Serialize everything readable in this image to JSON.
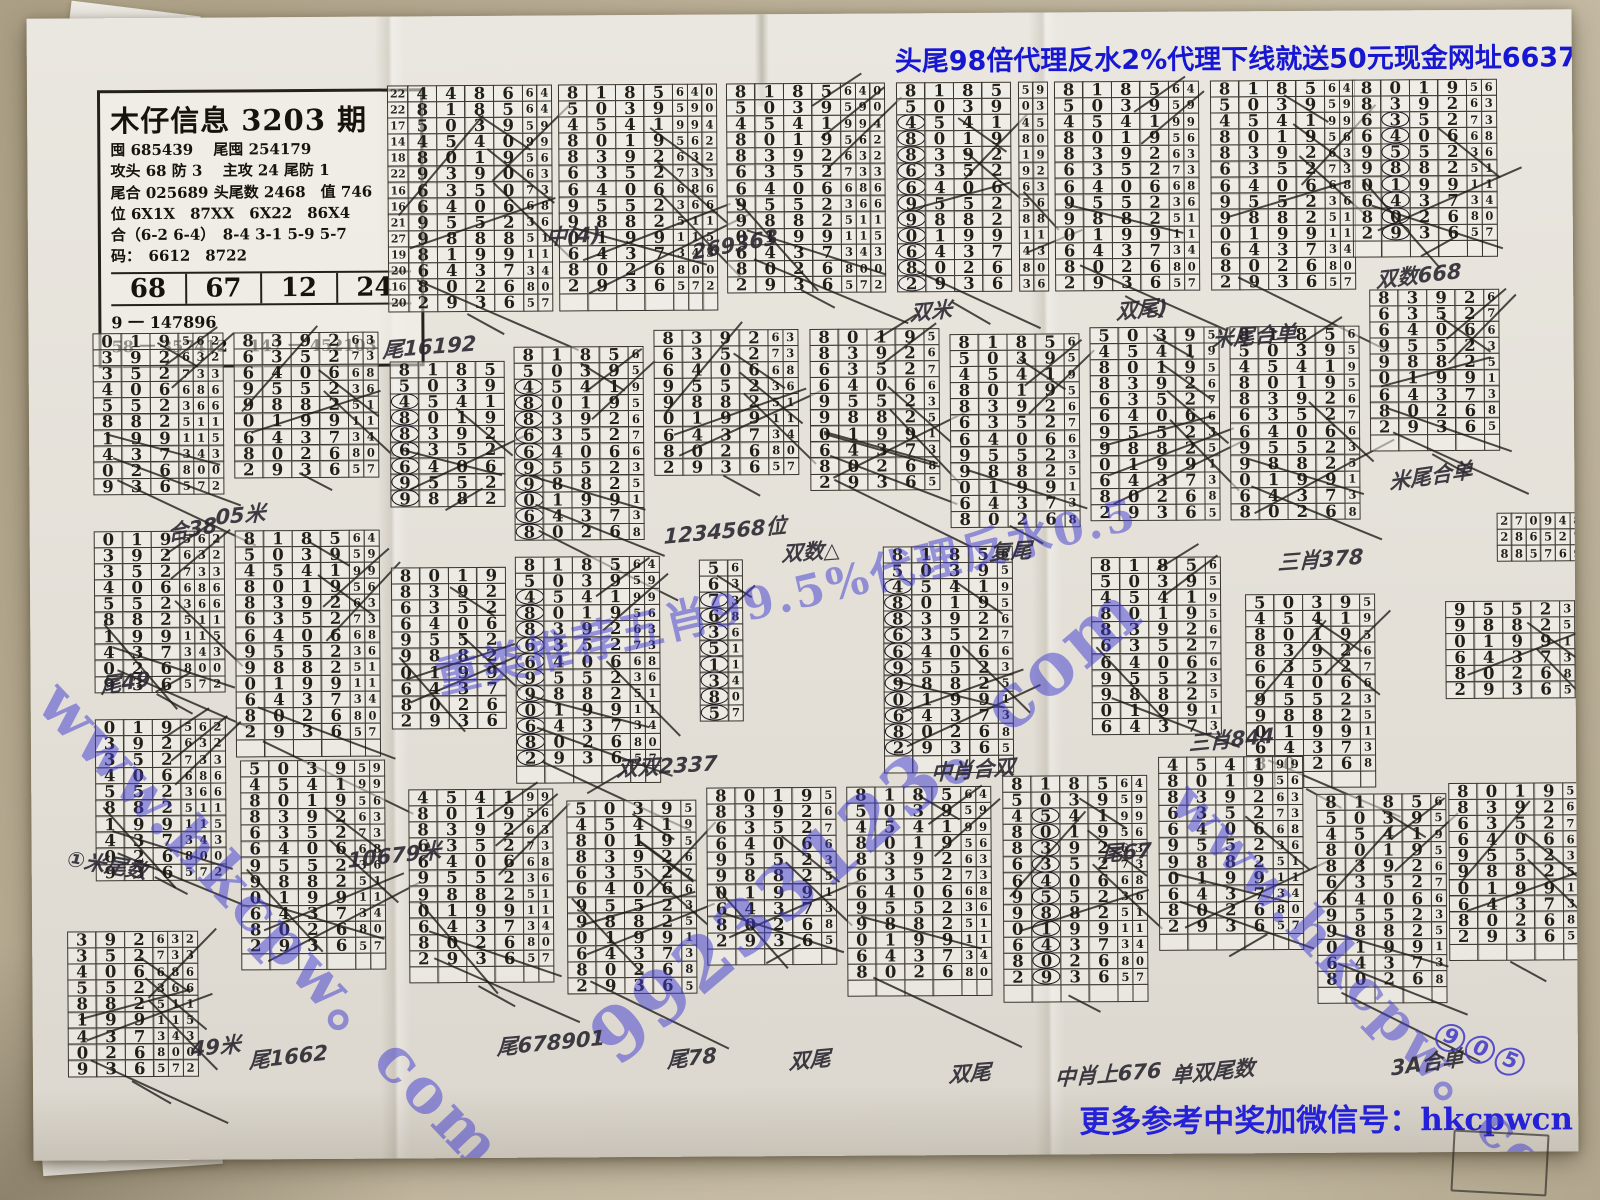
{
  "colors": {
    "banner_blue": "#1717d2",
    "ink": "#221f19",
    "watermark_blue": "#3e3ad0",
    "paper": "#e5e1d9",
    "table": "#b3a78c"
  },
  "banners": {
    "top": {
      "text": "头尾98倍代理反水2%代理下线就送50元现金网址66373.com",
      "x": 898,
      "y": 40
    },
    "bottom": {
      "text": "更多参考中奖加微信号：hkcpwcn",
      "x": 1076,
      "y": 1098
    }
  },
  "info": {
    "title": "木仔信息 3203 期",
    "lines": [
      "囤 685439　 尾囤 254179",
      "攻头 68 防 3　 主攻 24 尾防 1",
      "尾合 025689 头尾数 2468　值 746",
      "位 6X1X　87XX　6X22　86X4",
      "合（6-2 6-4）　8-4 3-1 5-9 5-7",
      "码：　6612　8722"
    ],
    "row": [
      "68",
      "67",
      "12",
      "24"
    ],
    "footer": [
      "9 一 147896",
      "58 一 357412　 147 一 452103"
    ]
  },
  "watermarks": [
    {
      "t": "www.hkcpw。com",
      "x": 86,
      "y": 652,
      "r": 47,
      "s": 62
    },
    {
      "t": "重类推荐五肖99.5%代理反水0.5",
      "x": 428,
      "y": 642,
      "r": -13,
      "s": 44
    },
    {
      "t": "99233123。com",
      "x": 560,
      "y": 1002,
      "r": -40,
      "s": 74
    },
    {
      "t": "www.hkcpw。com",
      "x": 1212,
      "y": 764,
      "r": 47,
      "s": 56
    }
  ],
  "stamps": [
    {
      "t": "尾16192",
      "x": 384,
      "y": 332,
      "r": -4
    },
    {
      "t": "中(4)",
      "x": 548,
      "y": 220,
      "r": -3
    },
    {
      "t": "269363",
      "x": 694,
      "y": 240,
      "r": -10
    },
    {
      "t": "双米",
      "x": 912,
      "y": 298,
      "r": -5
    },
    {
      "t": "双尾)",
      "x": 1118,
      "y": 298,
      "r": -5
    },
    {
      "t": "米尾合单",
      "x": 1214,
      "y": 326,
      "r": -4
    },
    {
      "t": "双数668",
      "x": 1378,
      "y": 268,
      "r": -6
    },
    {
      "t": "米尾合单",
      "x": 1390,
      "y": 470,
      "r": -8
    },
    {
      "t": "05米",
      "x": 216,
      "y": 498,
      "r": -5
    },
    {
      "t": "合38",
      "x": 168,
      "y": 514,
      "r": -10
    },
    {
      "t": "尾49",
      "x": 100,
      "y": 666,
      "r": -8
    },
    {
      "t": "1234568位",
      "x": 664,
      "y": 520,
      "r": -5
    },
    {
      "t": "双数△",
      "x": 782,
      "y": 538,
      "r": -4
    },
    {
      "t": "复尾",
      "x": 990,
      "y": 538,
      "r": -3
    },
    {
      "t": "三肖378",
      "x": 1278,
      "y": 550,
      "r": -4
    },
    {
      "t": "10679米",
      "x": 346,
      "y": 842,
      "r": -6
    },
    {
      "t": "双双2337",
      "x": 616,
      "y": 752,
      "r": -3
    },
    {
      "t": "中肖合双",
      "x": 930,
      "y": 758,
      "r": -4
    },
    {
      "t": "三肖844",
      "x": 1188,
      "y": 730,
      "r": -5
    },
    {
      "t": "①米尾数",
      "x": 66,
      "y": 838,
      "r": 10
    },
    {
      "t": "尾67",
      "x": 1100,
      "y": 840,
      "r": -4
    },
    {
      "t": "尾1662",
      "x": 246,
      "y": 1042,
      "r": -6
    },
    {
      "t": "49米",
      "x": 188,
      "y": 1030,
      "r": -6
    },
    {
      "t": "尾678901",
      "x": 494,
      "y": 1030,
      "r": -5
    },
    {
      "t": "尾78",
      "x": 664,
      "y": 1044,
      "r": -6
    },
    {
      "t": "双尾",
      "x": 786,
      "y": 1046,
      "r": -5
    },
    {
      "t": "双尾",
      "x": 946,
      "y": 1060,
      "r": -4
    },
    {
      "t": "中肖上676",
      "x": 1052,
      "y": 1064,
      "r": -4
    },
    {
      "t": "单双尾数",
      "x": 1168,
      "y": 1062,
      "r": -5
    },
    {
      "t": "3A合单",
      "x": 1388,
      "y": 1056,
      "r": -8
    },
    {
      "t": "905",
      "x": 1434,
      "y": 1022,
      "r": 22,
      "blue": true,
      "circles": true
    }
  ],
  "series": {
    "a6": [
      "448664",
      "818564",
      "503959",
      "454099",
      "801956",
      "939063",
      "635073",
      "640668",
      "955236",
      "988851",
      "819911",
      "643734",
      "802680",
      "293657"
    ],
    "b": [
      "8185640",
      "5039590",
      "4541994",
      "8019562",
      "8392632",
      "6352733",
      "6406686",
      "9552366",
      "9882511",
      "0199115",
      "6437343",
      "8026800",
      "2936572"
    ],
    "c": [
      "019562",
      "392632",
      "352733",
      "406686",
      "552366",
      "882511",
      "199115",
      "437343",
      "026800",
      "936572"
    ],
    "e": [
      "59",
      "03",
      "45",
      "80",
      "19",
      "92",
      "63",
      "56",
      "88",
      "11",
      "43",
      "80",
      "36"
    ],
    "e2": [
      "56",
      "63",
      "73",
      "68",
      "36",
      "51",
      "11",
      "34",
      "80",
      "57"
    ],
    "r3": [
      "2709480",
      "2865276",
      "8857690"
    ]
  },
  "blocks": [
    {
      "x": 391,
      "y": 84,
      "s": "a6",
      "f": 0,
      "n": 14,
      "b": 4,
      "m": 2,
      "k": 8,
      "L": [
        "22",
        "22",
        "17",
        "14",
        "18",
        "22",
        "16",
        "16",
        "21",
        "27",
        "19",
        "20",
        "16",
        "20"
      ]
    },
    {
      "x": 562,
      "y": 84,
      "s": "b",
      "f": 0,
      "n": 13,
      "b": 4,
      "m": 3,
      "k": 6,
      "p": 1
    },
    {
      "x": 730,
      "y": 84,
      "s": "b",
      "f": 0,
      "n": 13,
      "b": 4,
      "m": 3,
      "k": 7
    },
    {
      "x": 900,
      "y": 84,
      "s": "b",
      "f": 0,
      "n": 13,
      "b": 4,
      "m": 0,
      "k": 6,
      "c": 0
    },
    {
      "x": 1022,
      "y": 84,
      "s": "e",
      "f": 0,
      "n": 13,
      "b": 0,
      "m": 2,
      "k": 2
    },
    {
      "x": 1058,
      "y": 84,
      "s": "b",
      "f": 0,
      "n": 13,
      "b": 4,
      "m": 2,
      "k": 5
    },
    {
      "x": 1214,
      "y": 84,
      "s": "b",
      "f": 0,
      "n": 13,
      "b": 4,
      "m": 2,
      "k": 6
    },
    {
      "x": 1356,
      "y": 84,
      "s": "b",
      "f": 3,
      "n": 10,
      "b": 4,
      "m": 2,
      "k": 5,
      "c": 1,
      "p": 1
    },
    {
      "x": 95,
      "y": 330,
      "s": "c",
      "f": 0,
      "n": 10,
      "b": 3,
      "m": 3,
      "k": 6
    },
    {
      "x": 236,
      "y": 330,
      "s": "b",
      "f": 4,
      "n": 10,
      "b": 4,
      "m": 2,
      "k": 5
    },
    {
      "x": 392,
      "y": 360,
      "s": "b",
      "f": 0,
      "n": 9,
      "b": 4,
      "m": 0,
      "k": 4,
      "c": 0
    },
    {
      "x": 516,
      "y": 346,
      "s": "b",
      "f": 0,
      "n": 12,
      "b": 4,
      "m": 1,
      "k": 6,
      "c": 0
    },
    {
      "x": 656,
      "y": 330,
      "s": "b",
      "f": 4,
      "n": 9,
      "b": 4,
      "m": 2,
      "k": 7
    },
    {
      "x": 812,
      "y": 330,
      "s": "b",
      "f": 3,
      "n": 12,
      "b": 4,
      "m": 1,
      "k": 9
    },
    {
      "x": 952,
      "y": 336,
      "s": "b",
      "f": 0,
      "n": 12,
      "b": 4,
      "m": 1,
      "k": 5
    },
    {
      "x": 1092,
      "y": 330,
      "s": "b",
      "f": 1,
      "n": 12,
      "b": 4,
      "m": 1,
      "k": 7
    },
    {
      "x": 1232,
      "y": 330,
      "s": "b",
      "f": 0,
      "n": 12,
      "b": 4,
      "m": 1,
      "k": 5
    },
    {
      "x": 1372,
      "y": 294,
      "s": "b",
      "f": 4,
      "n": 9,
      "b": 4,
      "m": 1,
      "k": 7,
      "p": 1
    },
    {
      "x": 1498,
      "y": 518,
      "s": "r3",
      "f": 0,
      "n": 3,
      "b": 0,
      "m": 7,
      "k": 0
    },
    {
      "x": 95,
      "y": 528,
      "s": "c",
      "f": 0,
      "n": 10,
      "b": 3,
      "m": 3,
      "k": 8
    },
    {
      "x": 236,
      "y": 528,
      "s": "b",
      "f": 0,
      "n": 13,
      "b": 4,
      "m": 2,
      "k": 6,
      "p": 1
    },
    {
      "x": 392,
      "y": 566,
      "s": "b",
      "f": 3,
      "n": 11,
      "b": 4,
      "m": 0,
      "k": 5
    },
    {
      "x": 516,
      "y": 556,
      "s": "b",
      "f": 0,
      "n": 13,
      "b": 4,
      "m": 2,
      "k": 7,
      "c": 0,
      "p": 1
    },
    {
      "x": 700,
      "y": 560,
      "s": "e2",
      "f": 0,
      "n": 10,
      "b": 1,
      "m": 1,
      "k": 2,
      "c": 0
    },
    {
      "x": 884,
      "y": 548,
      "s": "b",
      "f": 0,
      "n": 13,
      "b": 4,
      "m": 1,
      "k": 5,
      "c": 0,
      "p": 1
    },
    {
      "x": 1092,
      "y": 560,
      "s": "b",
      "f": 0,
      "n": 11,
      "b": 4,
      "m": 1,
      "k": 4
    },
    {
      "x": 1246,
      "y": 598,
      "s": "b",
      "f": 1,
      "n": 11,
      "b": 4,
      "m": 1,
      "k": 6,
      "p": 1
    },
    {
      "x": 1446,
      "y": 606,
      "s": "b",
      "f": 7,
      "n": 6,
      "b": 4,
      "m": 2,
      "k": 3
    },
    {
      "x": 95,
      "y": 716,
      "s": "c",
      "f": 0,
      "n": 10,
      "b": 3,
      "m": 3,
      "k": 7
    },
    {
      "x": 66,
      "y": 928,
      "s": "c",
      "f": 1,
      "n": 9,
      "b": 3,
      "m": 3,
      "k": 8
    },
    {
      "x": 240,
      "y": 758,
      "s": "b",
      "f": 1,
      "n": 13,
      "b": 4,
      "m": 2,
      "k": 6,
      "p": 1
    },
    {
      "x": 408,
      "y": 788,
      "s": "b",
      "f": 2,
      "n": 11,
      "b": 4,
      "m": 2,
      "k": 7,
      "p": 1
    },
    {
      "x": 566,
      "y": 800,
      "s": "b",
      "f": 1,
      "n": 12,
      "b": 4,
      "m": 1,
      "k": 9
    },
    {
      "x": 706,
      "y": 788,
      "s": "b",
      "f": 3,
      "n": 12,
      "b": 4,
      "m": 1,
      "k": 6,
      "p": 1
    },
    {
      "x": 846,
      "y": 788,
      "s": "b",
      "f": 0,
      "n": 12,
      "b": 4,
      "m": 2,
      "k": 5,
      "p": 1
    },
    {
      "x": 1002,
      "y": 778,
      "s": "b",
      "f": 0,
      "n": 13,
      "b": 4,
      "m": 2,
      "k": 6,
      "c": 1,
      "p": 1
    },
    {
      "x": 1158,
      "y": 760,
      "s": "b",
      "f": 2,
      "n": 12,
      "b": 4,
      "m": 2,
      "k": 5,
      "p": 1
    },
    {
      "x": 1316,
      "y": 798,
      "s": "b",
      "f": 0,
      "n": 12,
      "b": 4,
      "m": 1,
      "k": 7,
      "p": 1
    },
    {
      "x": 1448,
      "y": 788,
      "s": "b",
      "f": 3,
      "n": 10,
      "b": 4,
      "m": 1,
      "k": 5,
      "p": 1
    }
  ]
}
